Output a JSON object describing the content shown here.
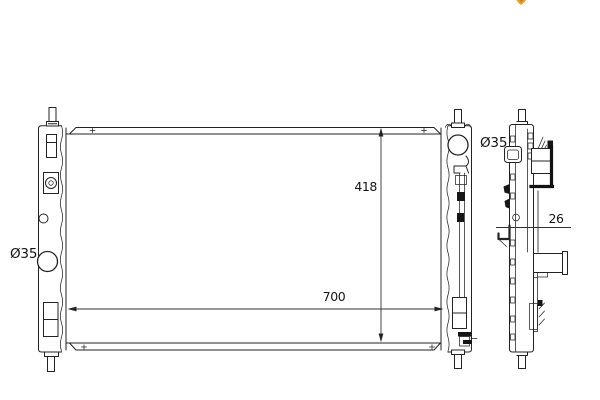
{
  "page": {
    "background_color": "#ffffff",
    "drawing_line_color": "#232323",
    "dimension_line_color": "#333333"
  },
  "logo": {
    "description": "partial-orange-logo-clipped-at-top-edge",
    "color_primary": "#e2a43c",
    "color_secondary": "#cd8526"
  },
  "drawing": {
    "type": "technical-drawing",
    "subject": "radiator-two-views",
    "annotations": {
      "inlet_diameter": "Ø35",
      "outlet_diameter": "Ø35",
      "core_height": "418",
      "core_width": "700",
      "core_depth": "26"
    }
  }
}
